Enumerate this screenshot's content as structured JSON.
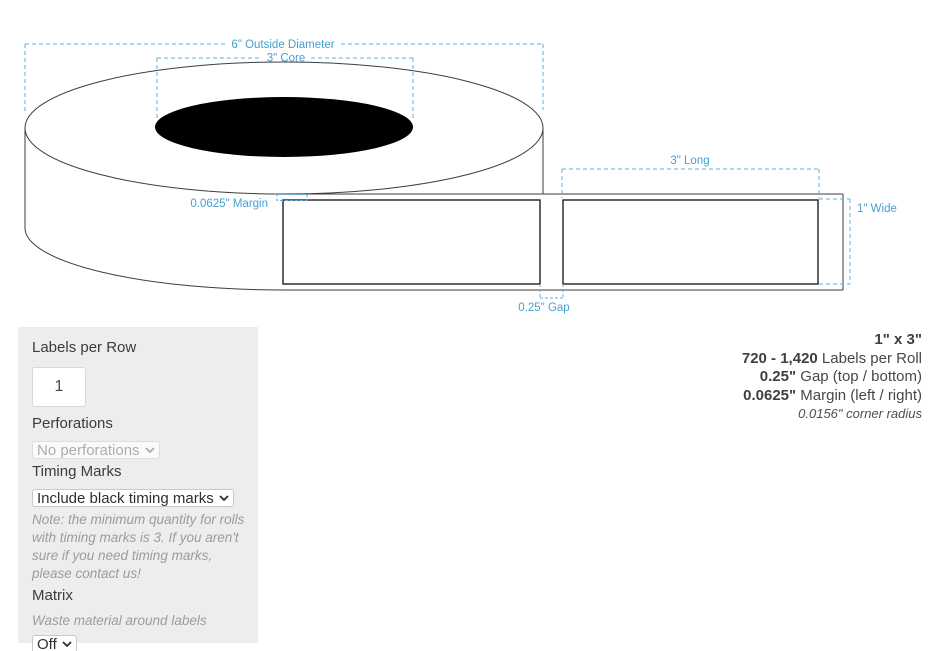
{
  "diagram": {
    "annotations": {
      "outside_diameter": "6\" Outside Diameter",
      "core": "3\" Core",
      "long": "3\" Long",
      "wide": "1\" Wide",
      "gap": "0.25\" Gap",
      "margin": "0.0625\" Margin"
    },
    "colors": {
      "annotation_blue": "#469fd2",
      "dash_blue": "#5fb0de",
      "outline": "#3e3e3e",
      "core_fill": "#000000"
    }
  },
  "options_panel": {
    "labels_per_row": {
      "label": "Labels per Row",
      "value": "1"
    },
    "perforations": {
      "label": "Perforations",
      "selected": "No perforations"
    },
    "timing_marks": {
      "label": "Timing Marks",
      "selected": "Include black timing marks",
      "note": "Note: the minimum quantity for rolls with timing marks is 3. If you aren't sure if you need timing marks, please contact us!"
    },
    "matrix": {
      "label": "Matrix",
      "description": "Waste material around labels",
      "selected": "Off"
    }
  },
  "summary": {
    "size": "1\" x 3\"",
    "labels_per_roll_value": "720 - 1,420",
    "labels_per_roll_text": " Labels per Roll",
    "gap_value": "0.25\"",
    "gap_text": " Gap (top / bottom)",
    "margin_value": "0.0625\"",
    "margin_text": " Margin (left / right)",
    "corner_radius": "0.0156\" corner radius"
  }
}
